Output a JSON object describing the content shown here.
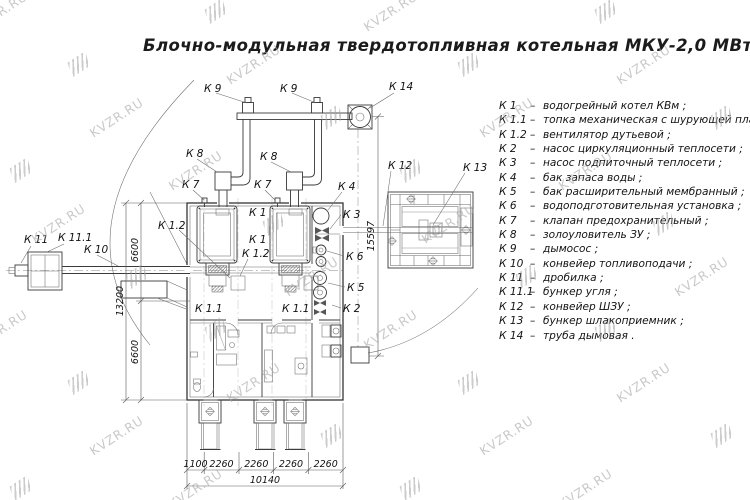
{
  "title": "Блочно-модульная твердотопливная котельная МКУ-2,0 МВт",
  "watermark": {
    "text": "KVZR.RU"
  },
  "legend": {
    "dash": "–",
    "items": [
      {
        "code": "К 1",
        "desc": "водогрейный котел КВм ;"
      },
      {
        "code": "К 1.1",
        "desc": "топка механическая с шурующей планкой ;"
      },
      {
        "code": "К 1.2",
        "desc": "вентилятор дутьевой ;"
      },
      {
        "code": "К 2",
        "desc": "насос циркуляционный теплосети ;"
      },
      {
        "code": "К 3",
        "desc": "насос подпиточный теплосети ;"
      },
      {
        "code": "К 4",
        "desc": "бак запаса воды ;"
      },
      {
        "code": "К 5",
        "desc": "бак расширительный мембранный ;"
      },
      {
        "code": "К 6",
        "desc": "водоподготовительная установка ;"
      },
      {
        "code": "К 7",
        "desc": "клапан предохранительный ;"
      },
      {
        "code": "К 8",
        "desc": "золоуловитель ЗУ ;"
      },
      {
        "code": "К 9",
        "desc": "дымосос ;"
      },
      {
        "code": "К 10",
        "desc": "конвейер топливоподачи ;"
      },
      {
        "code": "К 11",
        "desc": "дробилка ;"
      },
      {
        "code": "К 11.1",
        "desc": "бункер угля ;"
      },
      {
        "code": "К 12",
        "desc": "конвейер ШЗУ ;"
      },
      {
        "code": "К 13",
        "desc": "бункер шлакоприемник ;"
      },
      {
        "code": "К 14",
        "desc": "труба дымовая ."
      }
    ]
  },
  "drawing": {
    "labels": {
      "k9a": "К 9",
      "k9b": "К 9",
      "k14": "К 14",
      "k8a": "К 8",
      "k8b": "К 8",
      "k7a": "К 7",
      "k7b": "К 7",
      "k4": "К 4",
      "k12": "К 12",
      "k13": "К 13",
      "k3": "К 3",
      "k6": "К 6",
      "k5": "К 5",
      "k2": "К 2",
      "k1a": "К 1",
      "k1b": "К 1",
      "k1_2a": "К 1.2",
      "k1_2b": "К 1.2",
      "k1_1a": "К 1.1",
      "k1_1b": "К 1.1",
      "k11": "К 11",
      "k11_1": "К 11.1",
      "k10": "К 10"
    },
    "dims": {
      "bottom": [
        "1100",
        "2260",
        "2260",
        "2260",
        "2260"
      ],
      "bottom_total": "10140",
      "left_upper": "6600",
      "left_total": "13200",
      "left_lower": "6600",
      "right_height": "15597"
    }
  }
}
